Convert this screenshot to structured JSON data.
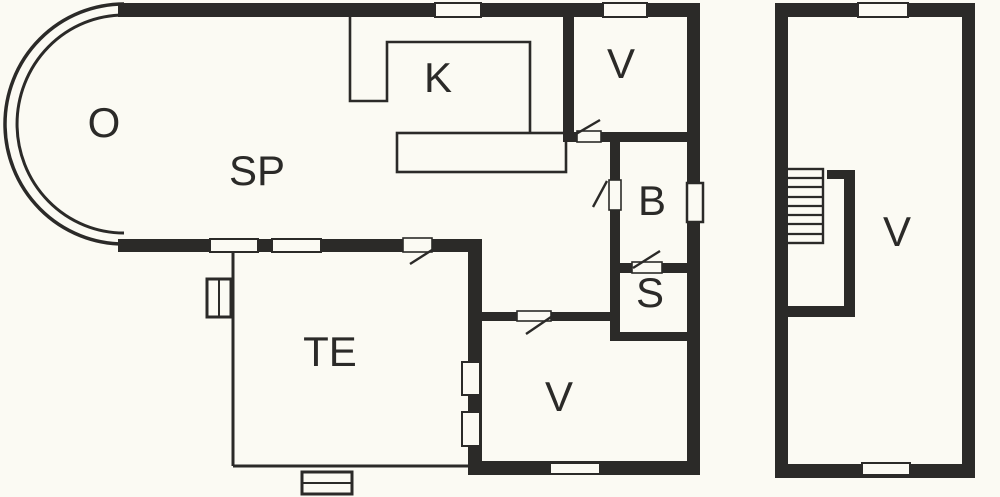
{
  "type": "floor-plan",
  "colors": {
    "wall": "#2b2a28",
    "background": "#fbfaf3",
    "line": "#2b2a28"
  },
  "buildings": {
    "main": {
      "name": "main house ground floor",
      "rooms": {
        "o": {
          "label": "O"
        },
        "sp": {
          "label": "SP"
        },
        "k": {
          "label": "K"
        },
        "v_top": {
          "label": "V"
        },
        "b": {
          "label": "B"
        },
        "s": {
          "label": "S"
        },
        "v_entry": {
          "label": "V"
        },
        "te": {
          "label": "TE"
        }
      }
    },
    "annex": {
      "name": "annex with staircase",
      "rooms": {
        "v": {
          "label": "V"
        }
      }
    }
  }
}
